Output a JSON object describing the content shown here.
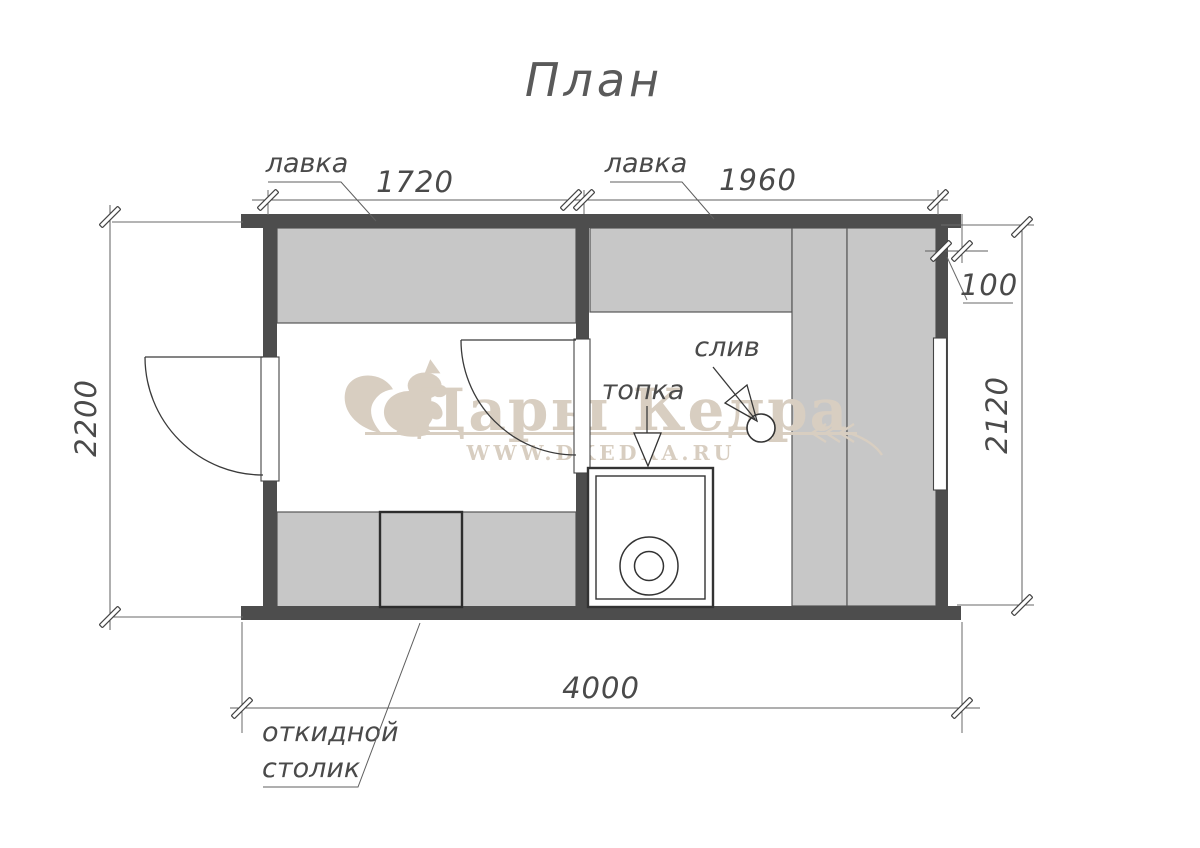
{
  "title": "План",
  "watermark": {
    "brand": "Дары Кедра",
    "url": "WWW.DKEDRA.RU",
    "logo_icon": "squirrel-icon"
  },
  "annotations": {
    "bench_left": "лавка",
    "bench_right": "лавка",
    "furnace": "топка",
    "drain": "слив",
    "folding_table_line1": "откидной",
    "folding_table_line2": "столик"
  },
  "dimensions": {
    "left_section_width": "1720",
    "right_section_width": "1960",
    "wall_offset": "100",
    "overall_depth": "2200",
    "inner_depth": "2120",
    "overall_width": "4000"
  },
  "colors": {
    "wall": "#4d4d4d",
    "bench": "#c7c7c7",
    "ink": "#4a4a4a",
    "watermark": "#d8cec1",
    "background": "#ffffff"
  }
}
